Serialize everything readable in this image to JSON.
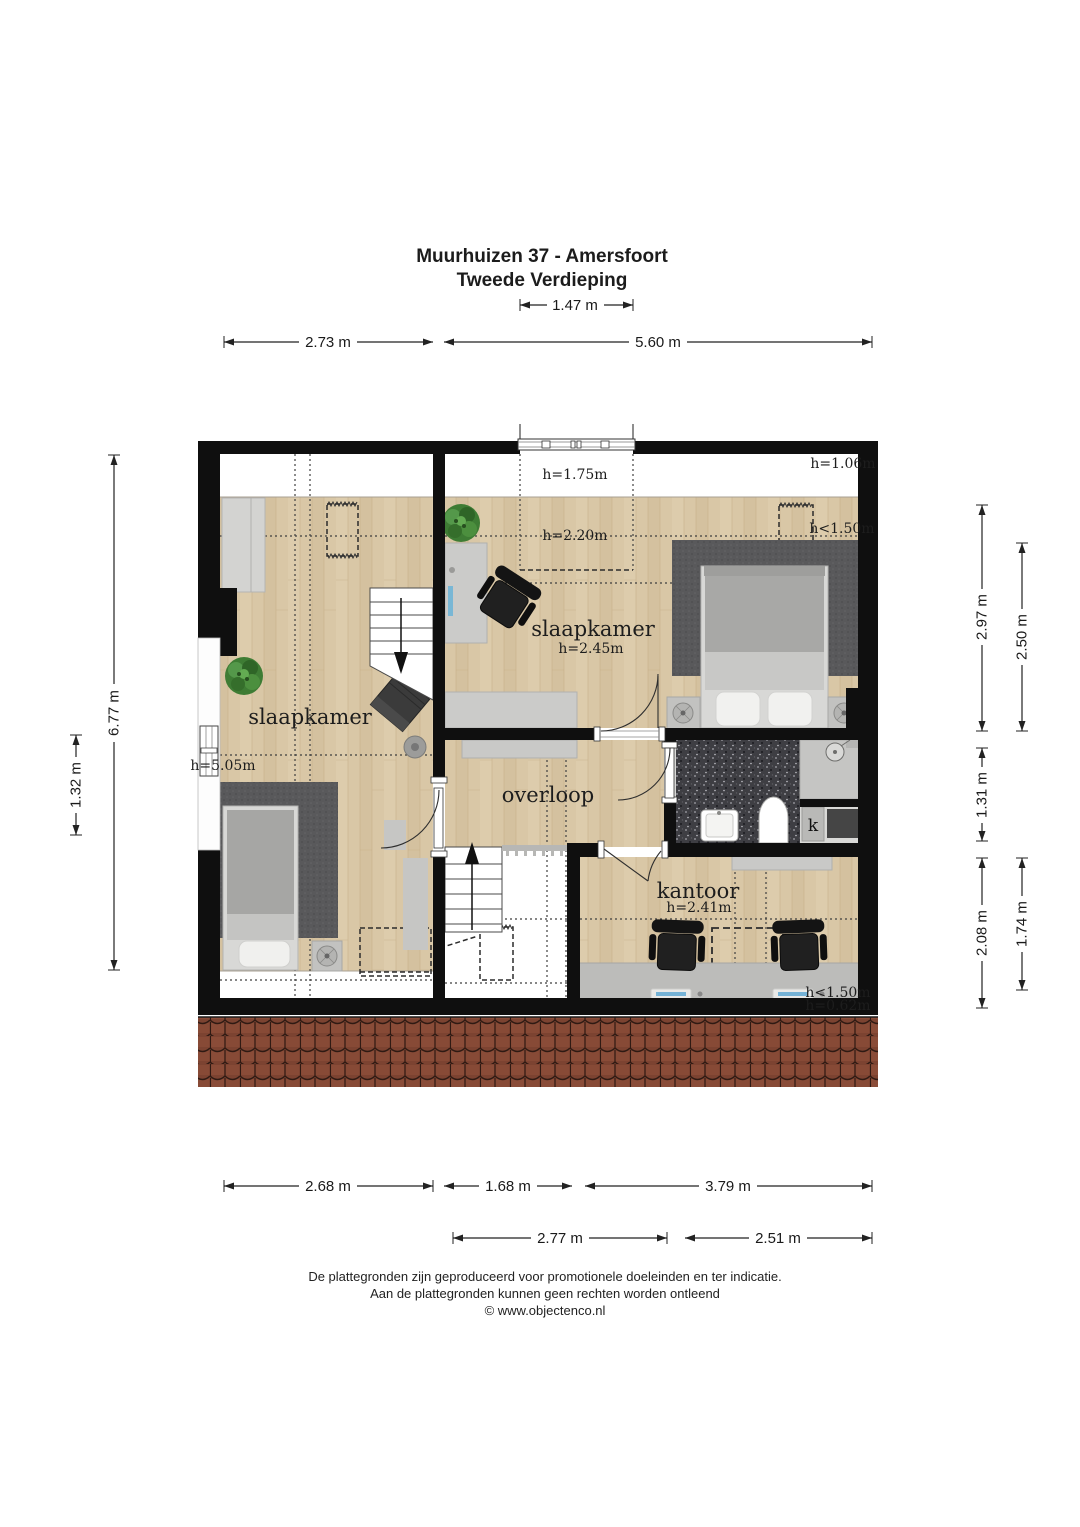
{
  "page": {
    "title_line1": "Muurhuizen 37 - Amersfoort",
    "title_line2": "Tweede Verdieping"
  },
  "dimensions": {
    "top_dormer": "1.47 m",
    "top_left": "2.73 m",
    "top_right": "5.60 m",
    "left_total": "6.77 m",
    "left_window": "1.32 m",
    "right_bedroom": "2.97 m",
    "right_bedroom_inner": "2.50 m",
    "right_bathroom": "1.31 m",
    "right_office": "2.08 m",
    "right_office_inner": "1.74 m",
    "bottom_left": "2.68 m",
    "bottom_stairs": "1.68 m",
    "bottom_office": "3.79 m",
    "bottom_landing": "2.77 m",
    "bottom_bath": "2.51 m"
  },
  "rooms": {
    "bedroom_left": {
      "name": "slaapkamer",
      "height": "h=5.05m"
    },
    "bedroom_right": {
      "name": "slaapkamer",
      "height": "h=2.45m"
    },
    "landing": {
      "name": "overloop"
    },
    "office": {
      "name": "kantoor",
      "height": "h=2.41m"
    },
    "closet": {
      "label": "k"
    }
  },
  "height_labels": {
    "dormer": "h=1.75m",
    "slope": "h=2.20m",
    "eaves_right": "h=1.06m",
    "low_headroom_bedroom": "h<1.50m",
    "low_headroom_office": "h<1.50m",
    "knee_wall_office": "h=0.62m"
  },
  "footer": {
    "line1": "De plattegronden zijn geproduceerd voor promotionele doeleinden en ter indicatie.",
    "line2": "Aan de plattegronden kunnen geen rechten worden ontleend",
    "line3": "© www.objectenco.nl"
  },
  "colors": {
    "wall": "#0f0f0f",
    "wood_floor": "#d9c7a6",
    "rug": "#59595b",
    "bathroom_floor": "#3e3e43",
    "roof_tiles": "#7c4331",
    "furniture_gray": "#c9c9c7",
    "plant_green": "#3e7c34",
    "dimension_text": "#1a1a1a"
  }
}
